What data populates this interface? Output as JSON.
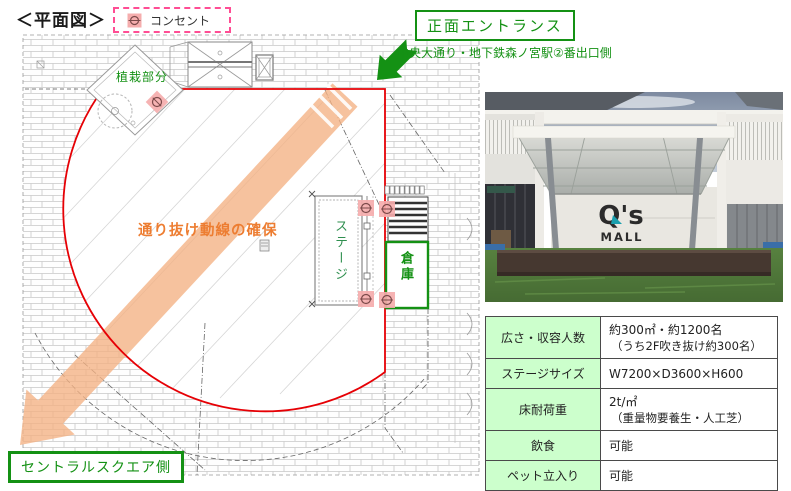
{
  "title": "＜平面図＞",
  "legend": {
    "outlet_label": "コンセント"
  },
  "plan": {
    "planting_label": "植栽部分",
    "flow_label": "通り抜け動線の確保",
    "stage_label": "ステージ",
    "storage_label": "倉庫",
    "front_entrance_label": "正面エントランス",
    "entrance_note": "中央大通り・地下鉄森ノ宮駅②番出口側",
    "central_square_label": "セントラルスクエア側"
  },
  "photo": {
    "logo_line1": "Q's",
    "logo_line2": "MALL"
  },
  "spec_table": {
    "rows": [
      {
        "label": "広さ・収容人数",
        "value": "約300㎡・約1200名",
        "note": "（うち2F吹き抜け約300名）"
      },
      {
        "label": "ステージサイズ",
        "value": "W7200×D3600×H600",
        "note": ""
      },
      {
        "label": "床耐荷重",
        "value": "2t/㎡",
        "note": "（重量物要養生・人工芝）"
      },
      {
        "label": "飲食",
        "value": "可能",
        "note": ""
      },
      {
        "label": "ペット立入り",
        "value": "可能",
        "note": ""
      }
    ]
  },
  "colors": {
    "green": "#149114",
    "red": "#e60005",
    "pink_legend": "#ff4d94",
    "outlet_pink": "#f5adad",
    "orange_band": "#f4b183",
    "orange_text": "#ed7d31",
    "table_label_bg": "#ccffcc",
    "logo_teal": "#1a9fae"
  }
}
